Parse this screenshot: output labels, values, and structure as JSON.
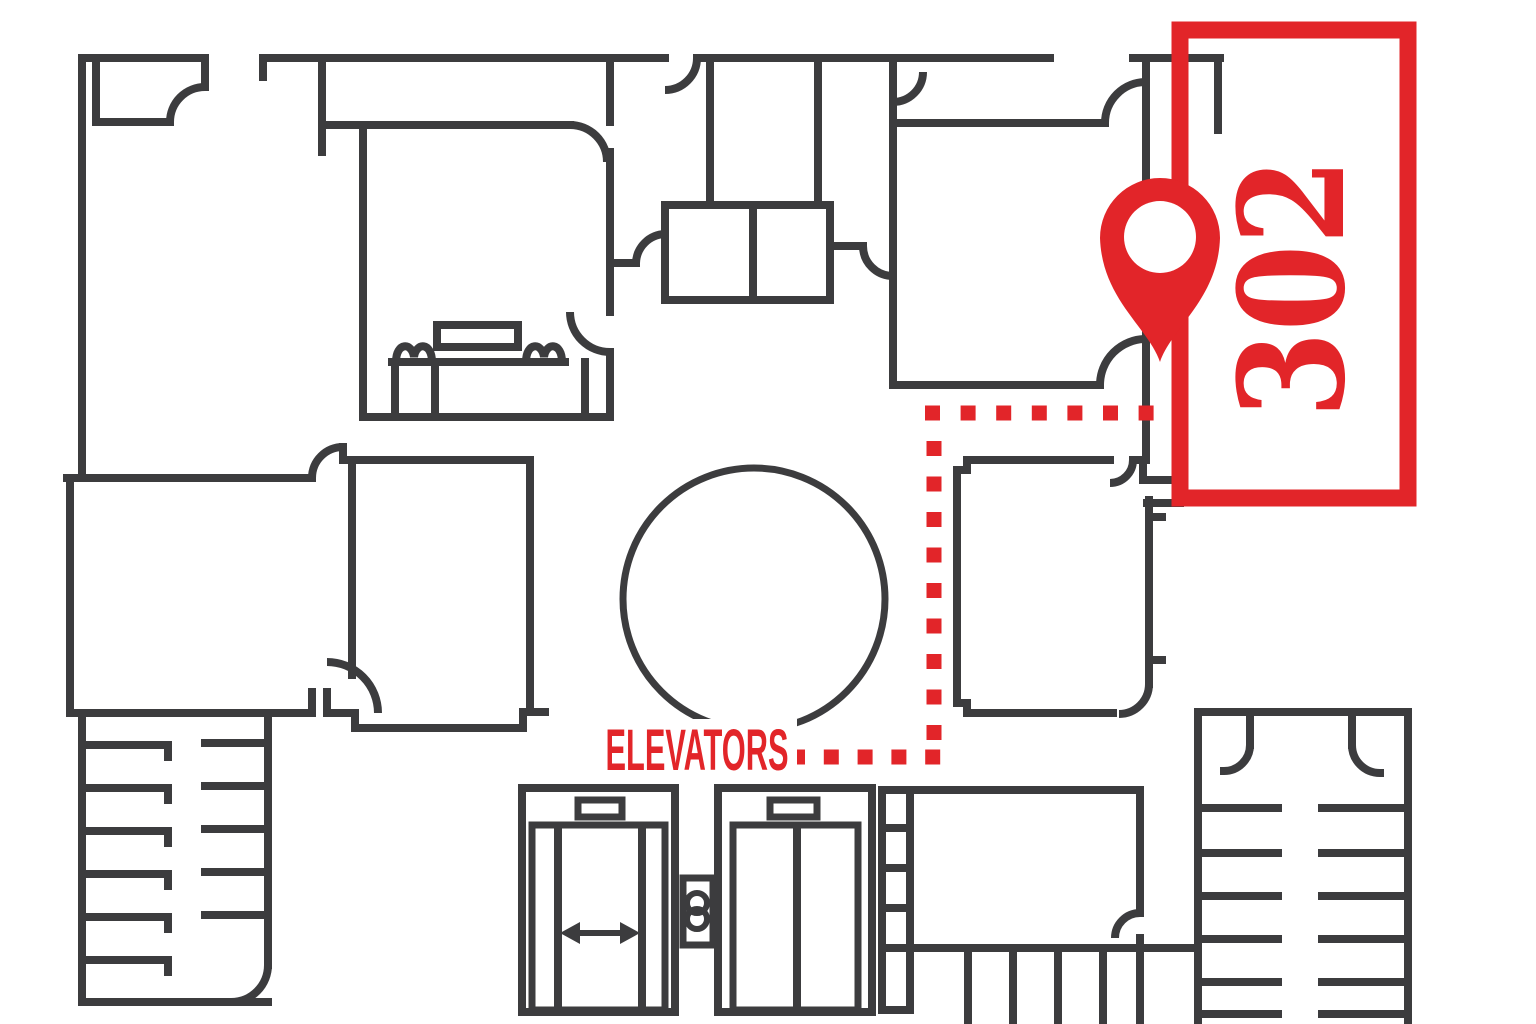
{
  "map": {
    "kind": "building floor plan with wayfinding route",
    "labels": {
      "room_number": "302",
      "elevators": "ELEVATORS"
    },
    "route": {
      "style": "dotted-square-path",
      "color": "#e22529",
      "from_label": "ELEVATORS",
      "to_room": "302"
    },
    "colors": {
      "accent_red": "#e22529",
      "wall_gray": "#3c3c3e",
      "background": "#ffffff"
    },
    "icons": [
      {
        "name": "location-pin-icon",
        "meaning": "destination marker at room 302"
      },
      {
        "name": "elevator-open-door-icon",
        "meaning": "elevator car with doors open"
      },
      {
        "name": "elevator-closed-door-icon",
        "meaning": "elevator car with doors closed"
      },
      {
        "name": "elevator-call-buttons-icon",
        "meaning": "call button panel between elevators"
      },
      {
        "name": "stairs-icon",
        "meaning": "stairwells at bottom left and bottom right"
      }
    ]
  }
}
